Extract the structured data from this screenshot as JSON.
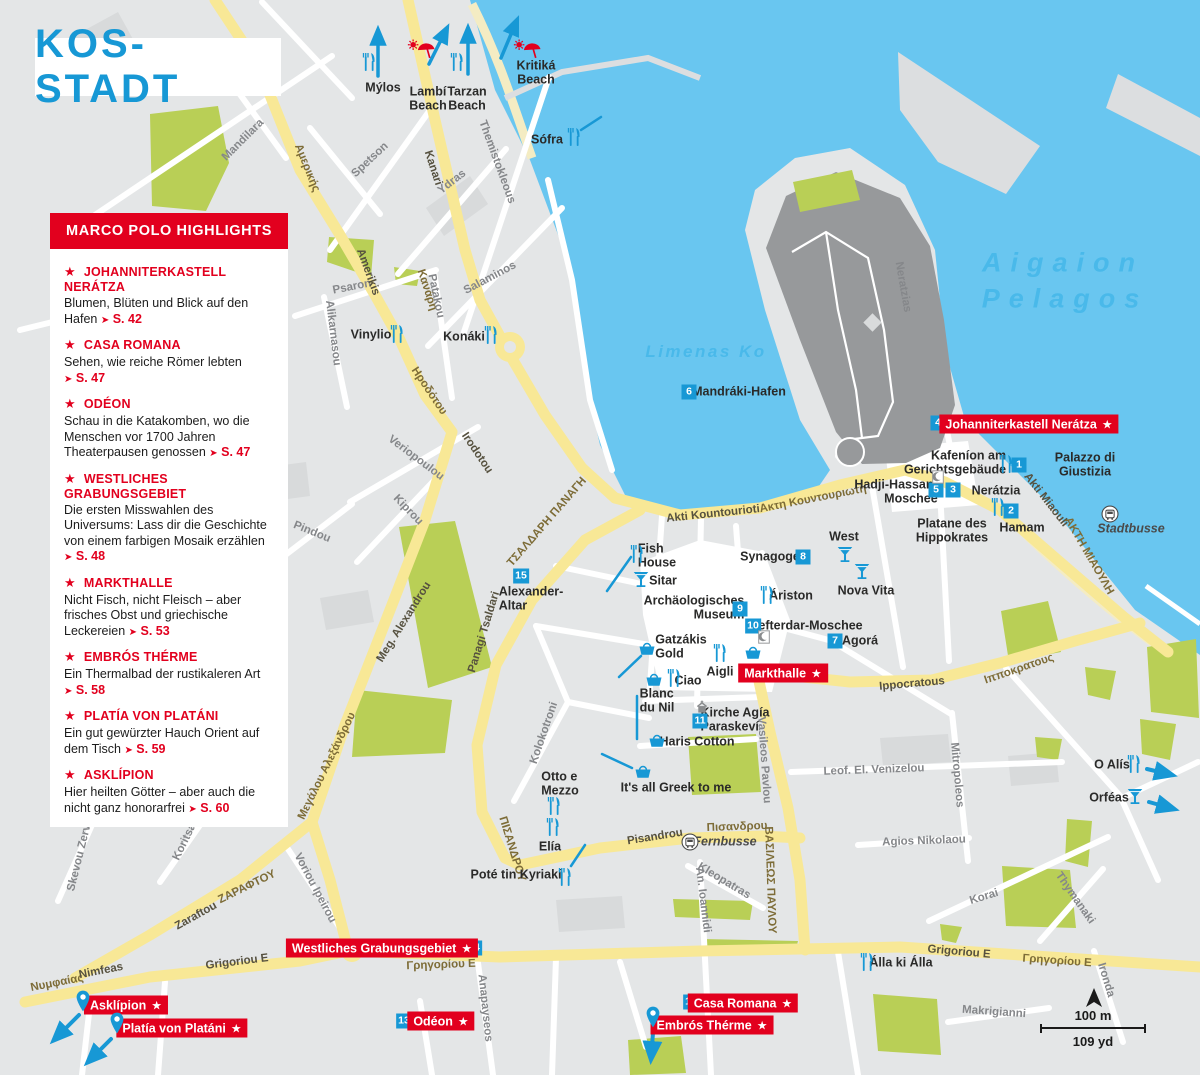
{
  "title": "KOS-STADT",
  "glyphs": {
    "star": "★",
    "pointer": "➤"
  },
  "highlights": {
    "header": "MARCO POLO HIGHLIGHTS",
    "items": [
      {
        "name": "JOHANNITERKASTELL NERÁTZA",
        "desc": "Blumen, Blüten und Blick auf den Hafen",
        "page": "S. 42"
      },
      {
        "name": "CASA ROMANA",
        "desc": "Sehen, wie reiche Römer lebten",
        "page": "S. 47"
      },
      {
        "name": "ODÉON",
        "desc": "Schau in die Katakomben, wo die Menschen vor 1700 Jahren Theaterpausen genossen",
        "page": "S. 47"
      },
      {
        "name": "WESTLICHES GRABUNGSGEBIET",
        "desc": "Die ersten Misswahlen des Universums: Lass dir die Geschichte von einem farbigen Mosaik erzählen",
        "page": "S. 48"
      },
      {
        "name": "MARKTHALLE",
        "desc": "Nicht Fisch, nicht Fleisch – aber frisches Obst und griechische Leckereien",
        "page": "S. 53"
      },
      {
        "name": "EMBRÓS THÉRME",
        "desc": "Ein Thermalbad der rustikaleren Art",
        "page": "S. 58"
      },
      {
        "name": "PLATÍA VON PLATÁNI",
        "desc": "Ein gut gewürzter Hauch Orient auf dem Tisch",
        "page": "S. 59"
      },
      {
        "name": "ASKLÍPION",
        "desc": "Hier heilten Götter – aber auch die nicht ganz honorarfrei",
        "page": "S. 60"
      }
    ]
  },
  "map": {
    "colors": {
      "sea": "#69c6f0",
      "land": "#e4e6e7",
      "park": "#b9cf56",
      "road_yellow": "#f8e896",
      "castle": "#97999b",
      "accent_blue": "#1798d5",
      "accent_red": "#e2001e"
    },
    "scale": {
      "m": "100 m",
      "yd": "109 yd"
    },
    "sea_labels": [
      {
        "t": "Aigaion",
        "x": 1063,
        "y": 263,
        "c": "big"
      },
      {
        "t": "Pelagos",
        "x": 1065,
        "y": 299,
        "c": "big"
      },
      {
        "t": "Limenas Ko",
        "x": 706,
        "y": 352,
        "c": "small"
      }
    ],
    "streets": [
      {
        "t": "Mandilara",
        "x": 243,
        "y": 140,
        "r": -45
      },
      {
        "t": "Αμερικής",
        "x": 307,
        "y": 168,
        "r": 68,
        "c": "o"
      },
      {
        "t": "Spetson",
        "x": 370,
        "y": 160,
        "r": -43
      },
      {
        "t": "Kanari",
        "x": 433,
        "y": 168,
        "r": 72,
        "c": "d"
      },
      {
        "t": "Κανάρη",
        "x": 427,
        "y": 290,
        "r": 72,
        "c": "o"
      },
      {
        "t": "Ydras",
        "x": 452,
        "y": 182,
        "r": -38
      },
      {
        "t": "Themistokleous",
        "x": 497,
        "y": 162,
        "r": 70
      },
      {
        "t": "Salaminos",
        "x": 490,
        "y": 278,
        "r": -28
      },
      {
        "t": "Psaron",
        "x": 352,
        "y": 287,
        "r": -11
      },
      {
        "t": "Patakou",
        "x": 436,
        "y": 296,
        "r": 78
      },
      {
        "t": "Alikarnassou",
        "x": 152,
        "y": 350,
        "r": 80
      },
      {
        "t": "Alikarnasou",
        "x": 333,
        "y": 333,
        "r": 83
      },
      {
        "t": "Amerikis",
        "x": 368,
        "y": 272,
        "r": 70,
        "c": "d"
      },
      {
        "t": "Ηροδότου",
        "x": 429,
        "y": 391,
        "r": 56,
        "c": "o"
      },
      {
        "t": "Irodotou",
        "x": 477,
        "y": 453,
        "r": 56,
        "c": "d"
      },
      {
        "t": "Veriopoulou",
        "x": 416,
        "y": 458,
        "r": 37
      },
      {
        "t": "Kiprou",
        "x": 408,
        "y": 510,
        "r": 46
      },
      {
        "t": "Pindou",
        "x": 312,
        "y": 532,
        "r": 22
      },
      {
        "t": "ΤΣΑΛΔΑΡΗ ΠΑΝΑΓΗ",
        "x": 547,
        "y": 522,
        "r": -49,
        "c": "o"
      },
      {
        "t": "Panagi Tsaldari",
        "x": 484,
        "y": 632,
        "r": -73,
        "c": "d"
      },
      {
        "t": "Meg. Alexandrou",
        "x": 404,
        "y": 622,
        "r": -58,
        "c": "d"
      },
      {
        "t": "Μεγάλου Αλεξάνδρου",
        "x": 327,
        "y": 766,
        "r": -64,
        "c": "o"
      },
      {
        "t": "Akti Kountourioti",
        "x": 713,
        "y": 514,
        "r": -6,
        "c": "d"
      },
      {
        "t": "Ακτη Κουντουριωτη",
        "x": 813,
        "y": 499,
        "r": -11,
        "c": "o"
      },
      {
        "t": "Akti Miaouli",
        "x": 1046,
        "y": 500,
        "r": 52,
        "c": "d"
      },
      {
        "t": "ΑΚΤΗ ΜΙΑΟΥΛΗ",
        "x": 1089,
        "y": 556,
        "r": 60,
        "c": "o"
      },
      {
        "t": "Neratzias",
        "x": 903,
        "y": 287,
        "r": 80
      },
      {
        "t": "Ippocratous",
        "x": 912,
        "y": 684,
        "r": -5,
        "c": "d"
      },
      {
        "t": "Ιπποκρατους",
        "x": 1019,
        "y": 669,
        "r": -19,
        "c": "o"
      },
      {
        "t": "Mitropoleos",
        "x": 957,
        "y": 775,
        "r": 85
      },
      {
        "t": "Leof. El. Venizelou",
        "x": 874,
        "y": 770,
        "r": -2
      },
      {
        "t": "Agios Nikolaou",
        "x": 924,
        "y": 841,
        "r": -2
      },
      {
        "t": "Korai",
        "x": 984,
        "y": 897,
        "r": -17
      },
      {
        "t": "Thymanaki",
        "x": 1075,
        "y": 898,
        "r": 55
      },
      {
        "t": "Vasileos Pavlou",
        "x": 764,
        "y": 760,
        "r": 86
      },
      {
        "t": "ΒΑΣΙΛΕΩΣ ΠΑΥΛΟΥ",
        "x": 770,
        "y": 880,
        "r": 88,
        "c": "o"
      },
      {
        "t": "Kolokotroni",
        "x": 544,
        "y": 733,
        "r": -71
      },
      {
        "t": "ΠΙΣΑΝΔΡΟΥ",
        "x": 512,
        "y": 849,
        "r": 73,
        "c": "o"
      },
      {
        "t": "Pisandrou",
        "x": 655,
        "y": 837,
        "r": -9,
        "c": "d"
      },
      {
        "t": "Πισανδρου",
        "x": 737,
        "y": 827,
        "r": -2,
        "c": "o"
      },
      {
        "t": "Kleopatras",
        "x": 724,
        "y": 881,
        "r": 31
      },
      {
        "t": "An. Ioannidi",
        "x": 703,
        "y": 900,
        "r": 83
      },
      {
        "t": "Grigoriou E",
        "x": 237,
        "y": 962,
        "r": -7,
        "c": "d"
      },
      {
        "t": "Γρηγορίου E",
        "x": 441,
        "y": 965,
        "r": -2,
        "c": "o"
      },
      {
        "t": "Grigoriou E",
        "x": 959,
        "y": 952,
        "r": 5,
        "c": "d"
      },
      {
        "t": "Γρηγορίου E",
        "x": 1057,
        "y": 961,
        "r": 4,
        "c": "o"
      },
      {
        "t": "Νυμφαίας",
        "x": 57,
        "y": 983,
        "r": -11,
        "c": "o"
      },
      {
        "t": "Nimfeas",
        "x": 101,
        "y": 971,
        "r": -11,
        "c": "d"
      },
      {
        "t": "Zaraftou",
        "x": 196,
        "y": 916,
        "r": -29,
        "c": "d"
      },
      {
        "t": "ΖΑΡΑΦΤΟΥ",
        "x": 247,
        "y": 887,
        "r": -26,
        "c": "o"
      },
      {
        "t": "Skevou Zervou",
        "x": 81,
        "y": 851,
        "r": -76
      },
      {
        "t": "Koritsas",
        "x": 186,
        "y": 839,
        "r": -64
      },
      {
        "t": "Voriou Ipeirou",
        "x": 315,
        "y": 888,
        "r": 62
      },
      {
        "t": "Makrigianni",
        "x": 994,
        "y": 1012,
        "r": 4
      },
      {
        "t": "Ironda",
        "x": 1106,
        "y": 980,
        "r": 73
      },
      {
        "t": "Anapayseos",
        "x": 485,
        "y": 1008,
        "r": 84
      }
    ],
    "pois": [
      {
        "t": "Mýlos",
        "x": 383,
        "y": 88
      },
      {
        "t": "Lambí\nBeach",
        "x": 428,
        "y": 99
      },
      {
        "t": "Tarzan\nBeach",
        "x": 467,
        "y": 99
      },
      {
        "t": "Kritiká\nBeach",
        "x": 536,
        "y": 73
      },
      {
        "t": "Sófra",
        "x": 547,
        "y": 140
      },
      {
        "t": "Vinylio",
        "x": 371,
        "y": 335
      },
      {
        "t": "Konáki",
        "x": 464,
        "y": 337
      },
      {
        "t": "Mandráki-Hafen",
        "x": 739,
        "y": 392
      },
      {
        "t": "Kafeníon am\nGerichtsgebäude",
        "x": 955,
        "y": 463,
        "ta": "r"
      },
      {
        "t": "Palazzo di Giustizia",
        "x": 1085,
        "y": 465
      },
      {
        "t": "Hadji-Hassan-\nMoschee",
        "x": 896,
        "y": 492,
        "ta": "r"
      },
      {
        "t": "Nerátzia",
        "x": 996,
        "y": 491
      },
      {
        "t": "Platane des\nHippokrates",
        "x": 952,
        "y": 531
      },
      {
        "t": "Hamam",
        "x": 1022,
        "y": 528
      },
      {
        "t": "Stadtbusse",
        "x": 1131,
        "y": 529,
        "c": "it"
      },
      {
        "t": "West",
        "x": 844,
        "y": 537
      },
      {
        "t": "Nova Vita",
        "x": 866,
        "y": 591
      },
      {
        "t": "Fish\nHouse",
        "x": 657,
        "y": 556,
        "ta": "l"
      },
      {
        "t": "Sitar",
        "x": 663,
        "y": 581
      },
      {
        "t": "Synagoge",
        "x": 770,
        "y": 557
      },
      {
        "t": "Áriston",
        "x": 791,
        "y": 596
      },
      {
        "t": "Archäologisches\nMuseum",
        "x": 694,
        "y": 608,
        "ta": "r"
      },
      {
        "t": "Defterdar-Moschee",
        "x": 806,
        "y": 626
      },
      {
        "t": "Agorá",
        "x": 860,
        "y": 641
      },
      {
        "t": "Gatzákis\nGold",
        "x": 681,
        "y": 647,
        "ta": "l"
      },
      {
        "t": "Aigli",
        "x": 720,
        "y": 672
      },
      {
        "t": "Ciao",
        "x": 688,
        "y": 681
      },
      {
        "t": "Blanc\ndu Nil",
        "x": 657,
        "y": 701,
        "ta": "l"
      },
      {
        "t": "Kirche Agía\nParaskeví",
        "x": 735,
        "y": 720,
        "ta": "l"
      },
      {
        "t": "Haris Cotton",
        "x": 697,
        "y": 742
      },
      {
        "t": "Otto e\nMezzo",
        "x": 560,
        "y": 784,
        "ta": "l"
      },
      {
        "t": "It's all Greek to me",
        "x": 676,
        "y": 788
      },
      {
        "t": "Elía",
        "x": 550,
        "y": 847
      },
      {
        "t": "Poté tin Kyriakí",
        "x": 516,
        "y": 875
      },
      {
        "t": "Fernbusse",
        "x": 725,
        "y": 842,
        "c": "it"
      },
      {
        "t": "O Alís",
        "x": 1112,
        "y": 765
      },
      {
        "t": "Orféas",
        "x": 1109,
        "y": 798
      },
      {
        "t": "Álla ki Álla",
        "x": 901,
        "y": 963
      },
      {
        "t": "Alexander-\nAltar",
        "x": 531,
        "y": 599,
        "ta": "l"
      }
    ],
    "badges": [
      {
        "n": "1",
        "x": 1019,
        "y": 465
      },
      {
        "n": "2",
        "x": 1011,
        "y": 511
      },
      {
        "n": "3",
        "x": 953,
        "y": 490
      },
      {
        "n": "4",
        "x": 938,
        "y": 423
      },
      {
        "n": "5",
        "x": 936,
        "y": 490
      },
      {
        "n": "6",
        "x": 689,
        "y": 392
      },
      {
        "n": "7",
        "x": 835,
        "y": 641
      },
      {
        "n": "8",
        "x": 803,
        "y": 557
      },
      {
        "n": "9",
        "x": 740,
        "y": 609
      },
      {
        "n": "10",
        "x": 753,
        "y": 626
      },
      {
        "n": "11",
        "x": 700,
        "y": 721
      },
      {
        "n": "12",
        "x": 691,
        "y": 1002
      },
      {
        "n": "13",
        "x": 404,
        "y": 1021
      },
      {
        "n": "14",
        "x": 474,
        "y": 948
      },
      {
        "n": "15",
        "x": 521,
        "y": 576
      }
    ],
    "red_labels": [
      {
        "t": "Johanniterkastell Nerátza",
        "x": 1029,
        "y": 424
      },
      {
        "t": "Markthalle",
        "x": 783,
        "y": 673
      },
      {
        "t": "Westliches Grabungsgebiet",
        "x": 382,
        "y": 948
      },
      {
        "t": "Asklípion",
        "x": 126,
        "y": 1005
      },
      {
        "t": "Platía von Platáni",
        "x": 182,
        "y": 1028
      },
      {
        "t": "Odéon",
        "x": 441,
        "y": 1021
      },
      {
        "t": "Casa Romana",
        "x": 743,
        "y": 1003
      },
      {
        "t": "Embrós Thérme",
        "x": 712,
        "y": 1025
      }
    ],
    "icons": [
      {
        "k": "fork",
        "x": 368,
        "y": 62
      },
      {
        "k": "fork",
        "x": 456,
        "y": 62
      },
      {
        "k": "fork",
        "x": 573,
        "y": 137
      },
      {
        "k": "fork",
        "x": 396,
        "y": 334
      },
      {
        "k": "fork",
        "x": 490,
        "y": 335
      },
      {
        "k": "fork",
        "x": 1005,
        "y": 464
      },
      {
        "k": "fork",
        "x": 997,
        "y": 507
      },
      {
        "k": "fork",
        "x": 636,
        "y": 554
      },
      {
        "k": "fork",
        "x": 766,
        "y": 595
      },
      {
        "k": "fork",
        "x": 719,
        "y": 653
      },
      {
        "k": "fork",
        "x": 673,
        "y": 678
      },
      {
        "k": "fork",
        "x": 553,
        "y": 806
      },
      {
        "k": "fork",
        "x": 552,
        "y": 827
      },
      {
        "k": "fork",
        "x": 564,
        "y": 877
      },
      {
        "k": "fork",
        "x": 866,
        "y": 962
      },
      {
        "k": "fork",
        "x": 1133,
        "y": 764
      },
      {
        "k": "cocktail",
        "x": 641,
        "y": 580
      },
      {
        "k": "cocktail",
        "x": 845,
        "y": 555
      },
      {
        "k": "cocktail",
        "x": 862,
        "y": 572
      },
      {
        "k": "cocktail",
        "x": 1135,
        "y": 797
      },
      {
        "k": "basket",
        "x": 647,
        "y": 648
      },
      {
        "k": "basket",
        "x": 753,
        "y": 652
      },
      {
        "k": "basket",
        "x": 654,
        "y": 679
      },
      {
        "k": "basket",
        "x": 657,
        "y": 740
      },
      {
        "k": "basket",
        "x": 643,
        "y": 771
      },
      {
        "k": "pin",
        "x": 83,
        "y": 1001
      },
      {
        "k": "pin",
        "x": 117,
        "y": 1023
      },
      {
        "k": "pin",
        "x": 653,
        "y": 1017
      },
      {
        "k": "bus",
        "x": 1110,
        "y": 514
      },
      {
        "k": "bus",
        "x": 690,
        "y": 842
      },
      {
        "k": "mosque",
        "x": 938,
        "y": 477
      },
      {
        "k": "mosque",
        "x": 764,
        "y": 637
      },
      {
        "k": "church",
        "x": 702,
        "y": 707
      },
      {
        "k": "beach",
        "x": 421,
        "y": 50
      },
      {
        "k": "beach",
        "x": 527,
        "y": 50
      }
    ],
    "lines": [
      {
        "x1": 378,
        "y1": 76,
        "x2": 378,
        "y2": 30,
        "w": 3.5,
        "a": 1
      },
      {
        "x1": 429,
        "y1": 64,
        "x2": 447,
        "y2": 28,
        "w": 3.5,
        "a": 1
      },
      {
        "x1": 468,
        "y1": 74,
        "x2": 468,
        "y2": 28,
        "w": 3.5,
        "a": 1
      },
      {
        "x1": 501,
        "y1": 58,
        "x2": 517,
        "y2": 20,
        "w": 3.5,
        "a": 1
      },
      {
        "x1": 581,
        "y1": 130,
        "x2": 601,
        "y2": 117,
        "w": 2.5,
        "a": 0
      },
      {
        "x1": 607,
        "y1": 591,
        "x2": 631,
        "y2": 557,
        "w": 2.5,
        "a": 0
      },
      {
        "x1": 619,
        "y1": 677,
        "x2": 641,
        "y2": 656,
        "w": 2.5,
        "a": 0
      },
      {
        "x1": 637,
        "y1": 696,
        "x2": 637,
        "y2": 739,
        "w": 2.5,
        "a": 0
      },
      {
        "x1": 602,
        "y1": 754,
        "x2": 632,
        "y2": 768,
        "w": 2.5,
        "a": 0
      },
      {
        "x1": 585,
        "y1": 845,
        "x2": 571,
        "y2": 866,
        "w": 2.5,
        "a": 0
      },
      {
        "x1": 1147,
        "y1": 769,
        "x2": 1172,
        "y2": 775,
        "w": 4,
        "a": 1
      },
      {
        "x1": 1149,
        "y1": 802,
        "x2": 1174,
        "y2": 809,
        "w": 4,
        "a": 1
      },
      {
        "x1": 79,
        "y1": 1015,
        "x2": 54,
        "y2": 1040,
        "w": 4,
        "a": 1
      },
      {
        "x1": 111,
        "y1": 1039,
        "x2": 88,
        "y2": 1062,
        "w": 4,
        "a": 1
      },
      {
        "x1": 653,
        "y1": 1033,
        "x2": 651,
        "y2": 1059,
        "w": 4,
        "a": 1
      }
    ]
  }
}
